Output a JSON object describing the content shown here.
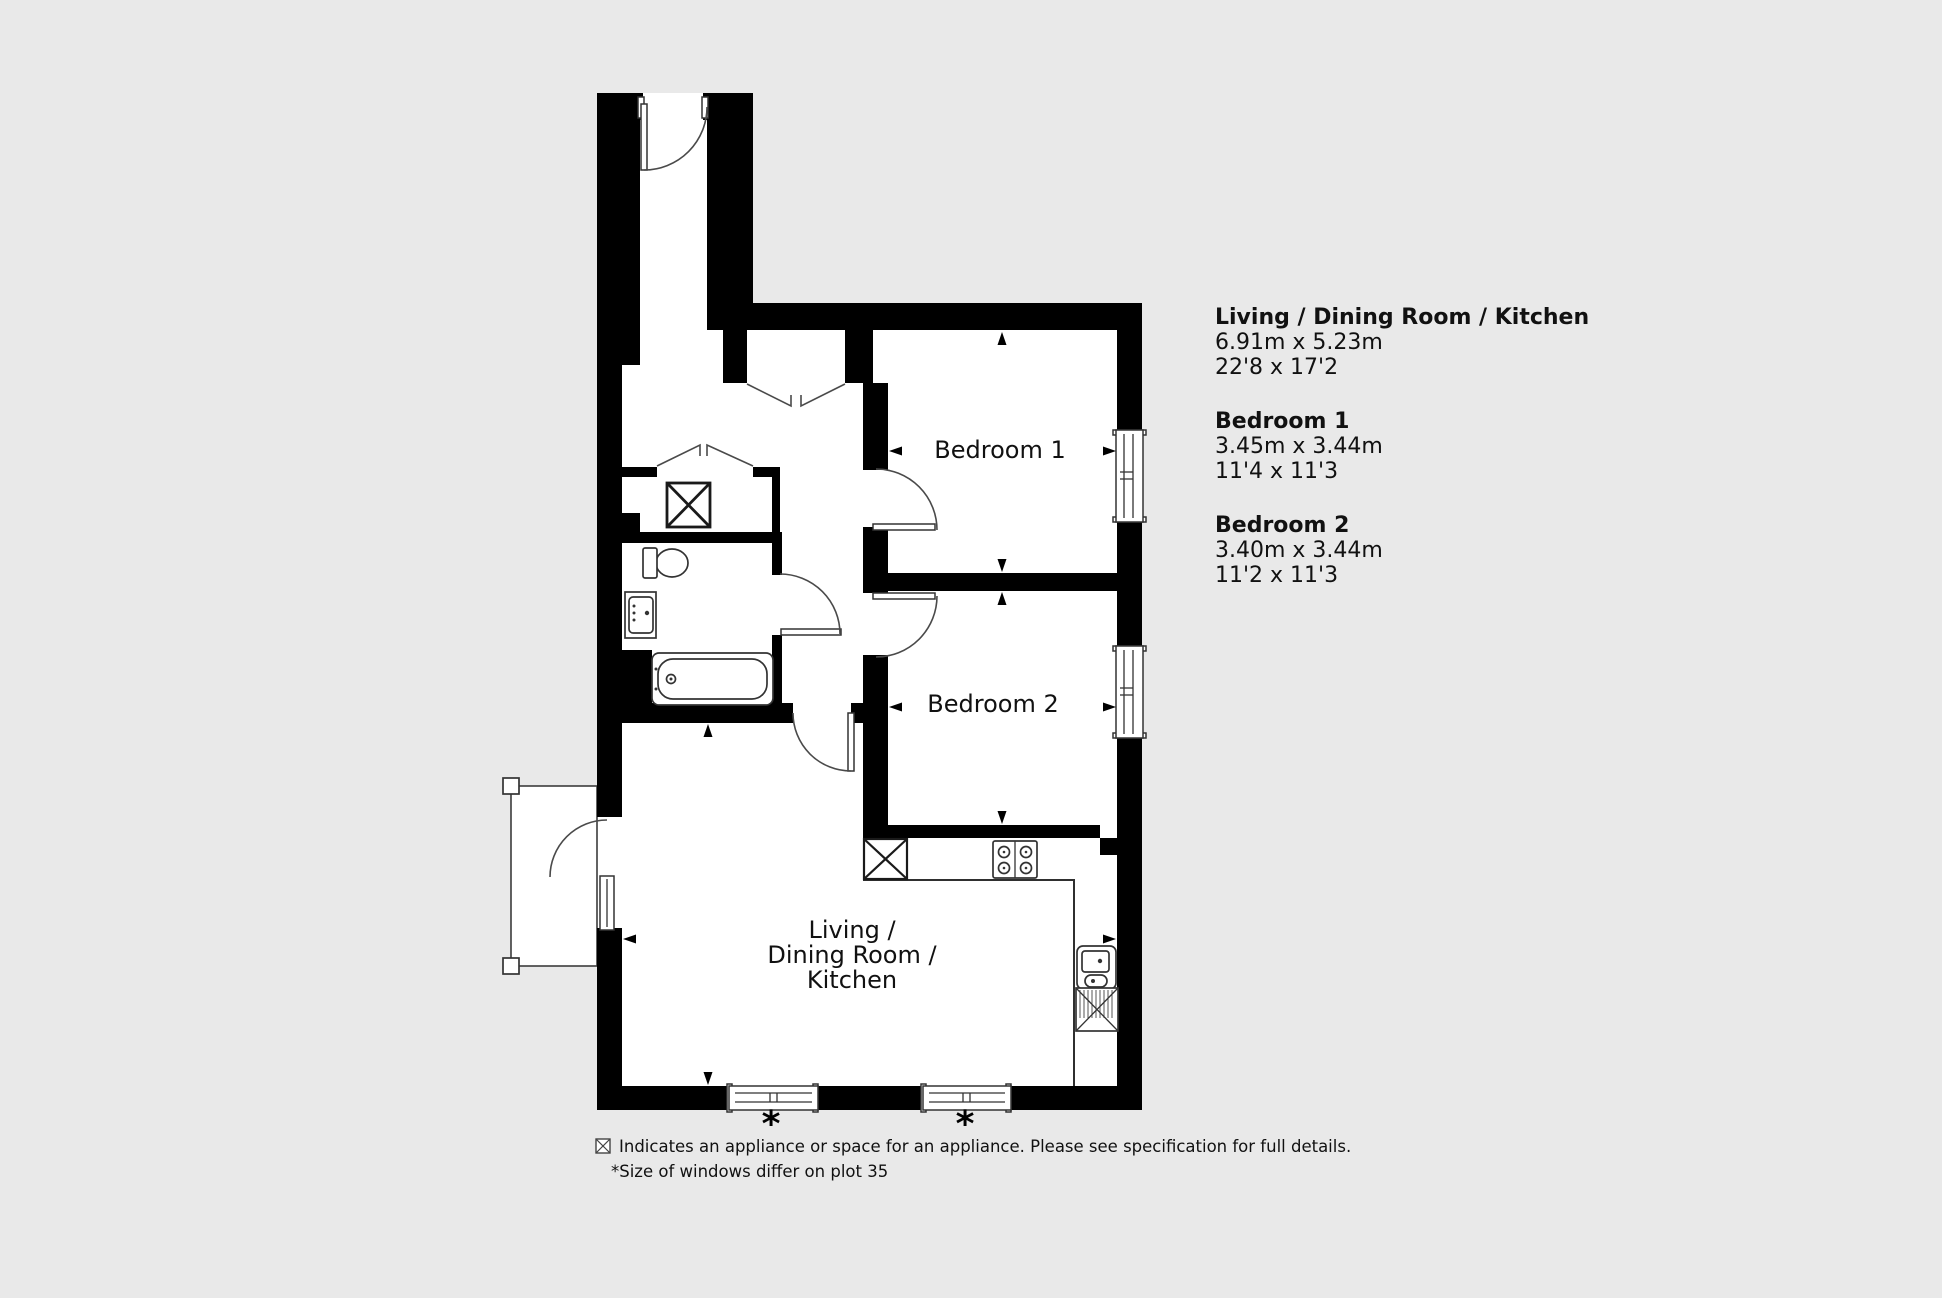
{
  "colors": {
    "background": "#e9e9e9",
    "wall": "#000000",
    "line": "#3c3c3c",
    "text": "#111111"
  },
  "plan": {
    "room_labels": {
      "bedroom1": "Bedroom 1",
      "bedroom2": "Bedroom 2",
      "living_line1": "Living /",
      "living_line2": "Dining Room /",
      "living_line3": "Kitchen"
    },
    "window_marker": "*"
  },
  "dimensions_panel": {
    "entries": [
      {
        "name": "Living / Dining Room / Kitchen",
        "metric": "6.91m x 5.23m",
        "imperial": "22'8 x 17'2"
      },
      {
        "name": "Bedroom 1",
        "metric": "3.45m x 3.44m",
        "imperial": "11'4 x 11'3"
      },
      {
        "name": "Bedroom 2",
        "metric": "3.40m x 3.44m",
        "imperial": "11'2 x 11'3"
      }
    ]
  },
  "legend": {
    "appliance_note": "Indicates an appliance or space for an appliance. Please see specification for full details.",
    "windows_note": "*Size of windows differ on plot 35"
  }
}
